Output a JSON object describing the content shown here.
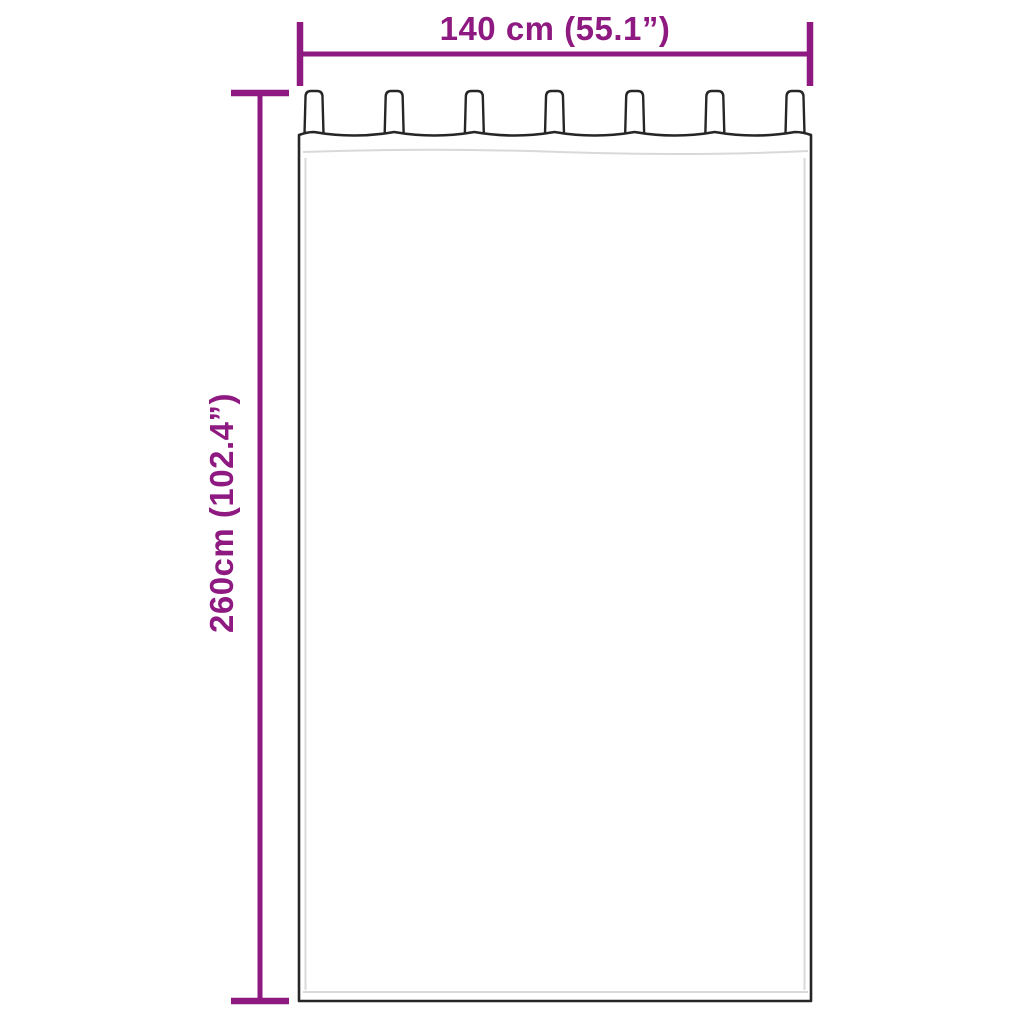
{
  "diagram": {
    "width_label": "140 cm (55.1”)",
    "height_label": "260cm (102.4”)",
    "tab_count": 7,
    "colors": {
      "accent": "#8E1980",
      "outline": "#262626",
      "hem_stitch": "#d9d9d9",
      "background": "#ffffff"
    }
  }
}
